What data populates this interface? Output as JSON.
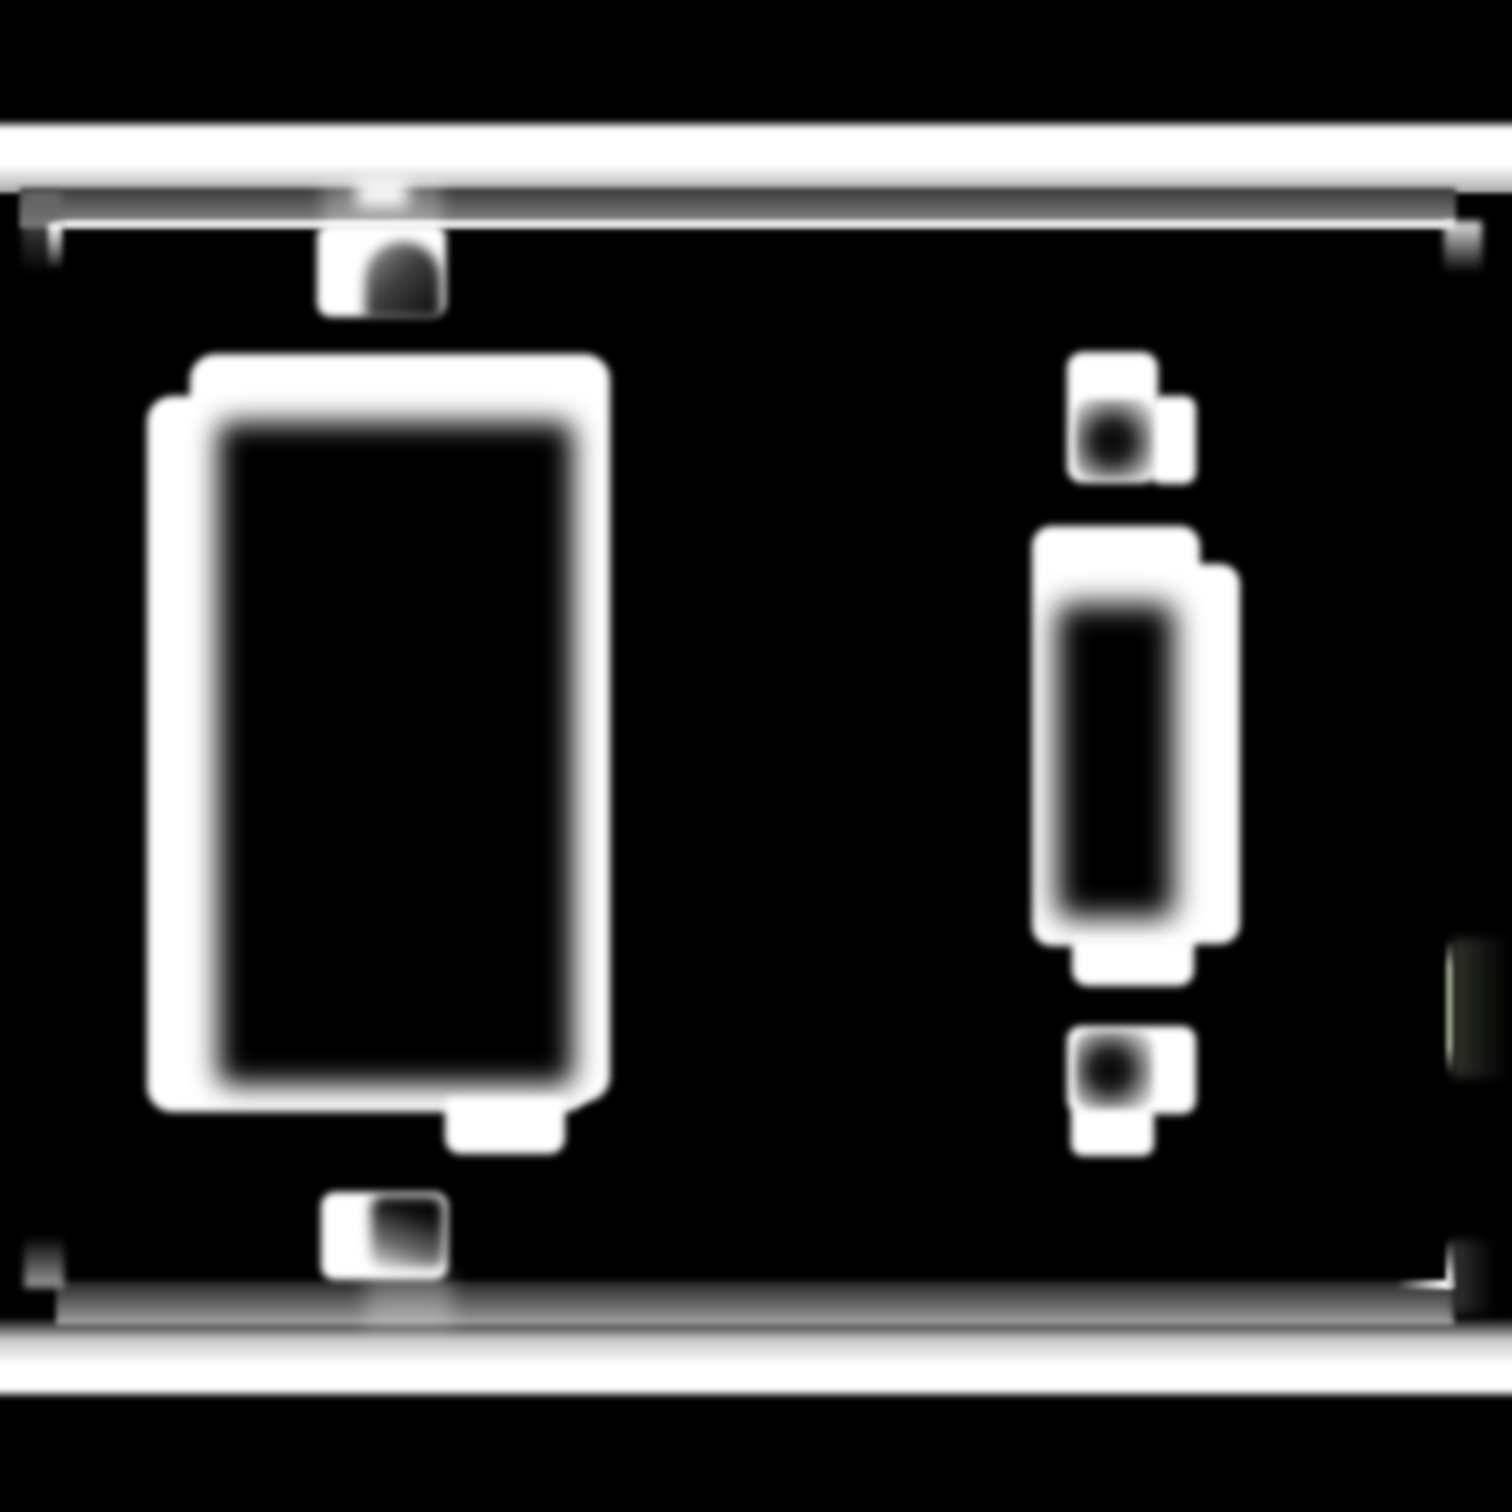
{
  "canvas": {
    "width": 1512,
    "height": 1512,
    "background": "#000000"
  },
  "scene": {
    "description": "Heavily blurred monochrome mask of a two-gang light-switch wall plate on a black background: white edge bars across the top and bottom, a faint inset plate outline with corner marks, a large dark rocker opening in a white frame on the left with screw tabs above and below, and a smaller toggle-switch opening in a white frame on the right with screw tabs above and below.",
    "palette": {
      "background": "#000000",
      "foreground": "#ffffff",
      "mid_gray": "#8f8f8f",
      "groove_tint": "#aab69c"
    }
  },
  "shapes": [
    {
      "name": "top-plate-edge-bar",
      "x": -6,
      "y": 119,
      "w": 1524,
      "h": 74,
      "bg": "linear-gradient(180deg, rgba(255,255,255,0) 0%, #ffffff 14%, #ffffff 62%, #a8a8a8 100%)",
      "blur": 2
    },
    {
      "name": "top-plate-face-band",
      "x": 20,
      "y": 188,
      "w": 1436,
      "h": 40,
      "bg": "linear-gradient(180deg, #383838 0%, #8f8f8f 100%)",
      "blur": 3
    },
    {
      "name": "top-plate-rim-highlight",
      "x": 54,
      "y": 220,
      "w": 1400,
      "h": 8,
      "bg": "#eaeaea",
      "blur": 2
    },
    {
      "name": "top-left-plate-corner-leg",
      "x": 22,
      "y": 192,
      "w": 40,
      "h": 82,
      "bg": "linear-gradient(180deg, rgba(105,105,105,0.95) 0%, rgba(40,40,40,0) 100%)",
      "blur": 4
    },
    {
      "name": "top-left-corner-glint",
      "x": 48,
      "y": 223,
      "w": 14,
      "h": 46,
      "bg": "linear-gradient(180deg, #ffffff 0%, rgba(255,255,255,0) 100%)",
      "blur": 3
    },
    {
      "name": "top-right-plate-corner-leg",
      "x": 1444,
      "y": 221,
      "w": 38,
      "h": 52,
      "bg": "linear-gradient(180deg, #e4e4e4 0%, rgba(70,70,70,0) 100%)",
      "blur": 4
    },
    {
      "name": "right-edge-groove-haze",
      "x": 1452,
      "y": 938,
      "w": 58,
      "h": 140,
      "bg": "linear-gradient(90deg, rgba(50,54,44,0.95) 0%, rgba(15,15,15,0) 100%)",
      "blur": 5
    },
    {
      "name": "right-edge-groove-line",
      "x": 1446,
      "y": 940,
      "w": 7,
      "h": 134,
      "bg": "linear-gradient(180deg, rgba(168,178,152,0) 0%, rgba(172,182,156,0.9) 20%, rgba(172,182,156,0.9) 80%, rgba(168,178,152,0) 100%)",
      "blur": 2
    },
    {
      "name": "bottom-plate-face-band",
      "x": 56,
      "y": 1281,
      "w": 1398,
      "h": 44,
      "bg": "linear-gradient(180deg, #242424 0%, #a2a2a2 100%)",
      "blur": 3
    },
    {
      "name": "bottom-plate-edge-bar",
      "x": -6,
      "y": 1317,
      "w": 1524,
      "h": 82,
      "bg": "linear-gradient(180deg, rgba(255,255,255,0) 0%, #c8c8c8 28%, #ffffff 58%, #ffffff 88%, rgba(255,255,255,0) 100%)",
      "blur": 2
    },
    {
      "name": "bottom-left-plate-corner-leg",
      "x": 24,
      "y": 1236,
      "w": 40,
      "h": 52,
      "bg": "linear-gradient(180deg, rgba(40,40,40,0) 0%, rgba(165,165,165,0.95) 100%)",
      "blur": 4
    },
    {
      "name": "bottom-right-corner-glint",
      "x": 1446,
      "y": 1238,
      "w": 9,
      "h": 50,
      "bg": "linear-gradient(180deg, rgba(255,255,255,0) 0%, #ffffff 75%, #ffffff 100%)",
      "blur": 2
    },
    {
      "name": "bottom-right-rim-glint",
      "x": 1396,
      "y": 1280,
      "w": 58,
      "h": 9,
      "bg": "linear-gradient(90deg, rgba(255,255,255,0) 0%, #ffffff 85%)",
      "blur": 2
    },
    {
      "name": "bottom-right-corner-haze",
      "x": 1452,
      "y": 1240,
      "w": 42,
      "h": 74,
      "bg": "linear-gradient(90deg, rgba(60,60,60,0.9) 0%, rgba(20,20,20,0) 100%)",
      "blur": 5
    },
    {
      "name": "rocker-top-screw-streak",
      "x": 322,
      "y": 180,
      "w": 120,
      "h": 52,
      "bg": "rgba(255,255,255,0.28)",
      "blur": 8
    },
    {
      "name": "rocker-top-screw-glint",
      "x": 356,
      "y": 178,
      "w": 52,
      "h": 30,
      "bg": "rgba(255,255,255,0.95)",
      "blur": 8
    },
    {
      "name": "rocker-top-screw-plate",
      "x": 317,
      "y": 224,
      "w": 129,
      "h": 93,
      "bg": "#ffffff",
      "radius": "14px",
      "blur": 4
    },
    {
      "name": "rocker-top-screw-shadow",
      "x": 365,
      "y": 242,
      "w": 76,
      "h": 77,
      "bg": "linear-gradient(135deg, rgba(0,0,0,0.38) 0%, rgba(0,0,0,0.75) 45%, rgba(0,0,0,0.97) 100%)",
      "radius": "38px 38px 4px 4px",
      "blur": 6
    },
    {
      "name": "rocker-frame-outer-upper",
      "x": 190,
      "y": 354,
      "w": 420,
      "h": 748,
      "bg": "#ffffff",
      "radius": "26px",
      "blur": 4
    },
    {
      "name": "rocker-frame-outer-lower",
      "x": 147,
      "y": 396,
      "w": 443,
      "h": 716,
      "bg": "#ffffff",
      "radius": "26px",
      "blur": 4
    },
    {
      "name": "rocker-opening",
      "x": 218,
      "y": 422,
      "w": 355,
      "h": 663,
      "bg": "#000000",
      "radius": "12px",
      "blur": 14
    },
    {
      "name": "rocker-bottom-tab",
      "x": 445,
      "y": 1098,
      "w": 120,
      "h": 56,
      "bg": "#ffffff",
      "radius": "6px 6px 16px 16px",
      "blur": 4
    },
    {
      "name": "rocker-bottom-screw-streak",
      "x": 366,
      "y": 1274,
      "w": 86,
      "h": 54,
      "bg": "rgba(255,255,255,0.28)",
      "blur": 10
    },
    {
      "name": "rocker-bottom-screw-plate",
      "x": 321,
      "y": 1192,
      "w": 127,
      "h": 88,
      "bg": "#ffffff",
      "radius": "14px",
      "blur": 4
    },
    {
      "name": "rocker-bottom-screw-shadow",
      "x": 371,
      "y": 1196,
      "w": 73,
      "h": 72,
      "bg": "linear-gradient(200deg, rgba(0,0,0,0.97) 25%, rgba(0,0,0,0.55) 70%, rgba(0,0,0,0.1) 100%)",
      "radius": "12px",
      "blur": 6
    },
    {
      "name": "toggle-top-screw-plate",
      "x": 1067,
      "y": 352,
      "w": 91,
      "h": 131,
      "bg": "#ffffff",
      "radius": "16px",
      "blur": 4
    },
    {
      "name": "toggle-top-screw-plate-lobe",
      "x": 1150,
      "y": 396,
      "w": 46,
      "h": 88,
      "bg": "#ffffff",
      "radius": "12px",
      "blur": 4
    },
    {
      "name": "toggle-top-screw-shadow",
      "x": 1075,
      "y": 399,
      "w": 78,
      "h": 80,
      "bg": "radial-gradient(circle at 48% 53%, rgba(0,0,0,0.98) 0%, rgba(0,0,0,0.88) 30%, rgba(0,0,0,0.3) 72%, rgba(0,0,0,0) 100%)",
      "radius": "16px",
      "blur": 4
    },
    {
      "name": "toggle-frame-outer",
      "x": 1032,
      "y": 526,
      "w": 168,
      "h": 420,
      "bg": "#ffffff",
      "radius": "20px",
      "blur": 4
    },
    {
      "name": "toggle-frame-outer-lobe",
      "x": 1154,
      "y": 564,
      "w": 86,
      "h": 380,
      "bg": "#ffffff",
      "radius": "20px",
      "blur": 4
    },
    {
      "name": "toggle-lever-opening",
      "x": 1057,
      "y": 604,
      "w": 117,
      "h": 314,
      "bg": "#000000",
      "radius": "12px",
      "blur": 15
    },
    {
      "name": "toggle-bottom-tab",
      "x": 1072,
      "y": 938,
      "w": 122,
      "h": 48,
      "bg": "#ffffff",
      "radius": "6px 6px 16px 16px",
      "blur": 4
    },
    {
      "name": "toggle-bottom-screw-plate",
      "x": 1067,
      "y": 1026,
      "w": 129,
      "h": 88,
      "bg": "#ffffff",
      "radius": "14px",
      "blur": 4
    },
    {
      "name": "toggle-bottom-screw-plate-lobe",
      "x": 1071,
      "y": 1104,
      "w": 83,
      "h": 52,
      "bg": "#ffffff",
      "radius": "12px",
      "blur": 4
    },
    {
      "name": "toggle-bottom-screw-shadow",
      "x": 1075,
      "y": 1031,
      "w": 78,
      "h": 78,
      "bg": "radial-gradient(circle at 45% 50%, rgba(0,0,0,0.98) 0%, rgba(0,0,0,0.88) 30%, rgba(0,0,0,0.3) 72%, rgba(0,0,0,0) 100%)",
      "radius": "16px",
      "blur": 4
    }
  ]
}
